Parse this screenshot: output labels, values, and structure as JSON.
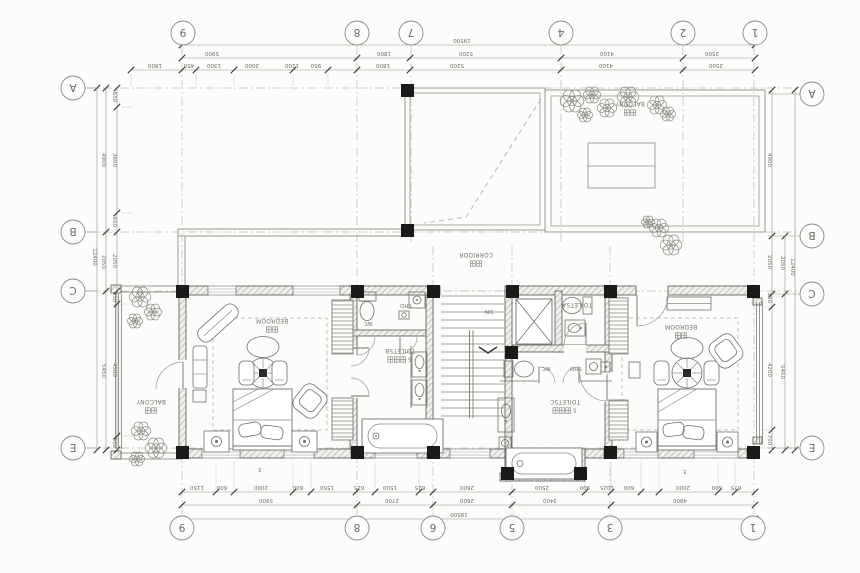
{
  "drawing": {
    "type": "architectural-floor-plan",
    "orientation": "rotated-180",
    "overall_width_mm": "19500",
    "overall_height_mm": "12400"
  },
  "colors": {
    "paper": "#fcfcfa",
    "line": "#8f8f8c",
    "dark": "#2f2f2d",
    "dim_text": "#6a6a66",
    "column": "#1a1a18",
    "hatch": "#a09f9c"
  },
  "bubbles": {
    "top": {
      "y": 33,
      "items": [
        {
          "t": "9",
          "x": 183
        },
        {
          "t": "8",
          "x": 357
        },
        {
          "t": "7",
          "x": 411
        },
        {
          "t": "4",
          "x": 561
        },
        {
          "t": "2",
          "x": 683
        },
        {
          "t": "1",
          "x": 755
        }
      ]
    },
    "bottom": {
      "y": 528,
      "items": [
        {
          "t": "9",
          "x": 182
        },
        {
          "t": "8",
          "x": 357
        },
        {
          "t": "6",
          "x": 433
        },
        {
          "t": "5",
          "x": 512
        },
        {
          "t": "3",
          "x": 610
        },
        {
          "t": "1",
          "x": 753
        }
      ]
    },
    "left": {
      "x": 73,
      "items": [
        {
          "t": "A",
          "y": 88
        },
        {
          "t": "B",
          "y": 232
        },
        {
          "t": "C",
          "y": 291
        },
        {
          "t": "E",
          "y": 448
        }
      ]
    },
    "right": {
      "x": 812,
      "items": [
        {
          "t": "A",
          "y": 94
        },
        {
          "t": "B",
          "y": 236
        },
        {
          "t": "C",
          "y": 294
        },
        {
          "t": "E",
          "y": 448
        }
      ]
    }
  },
  "dim_rows": [
    {
      "y": 45,
      "ticks": [
        182,
        755
      ],
      "labels": [
        {
          "t": "19500",
          "x": 462
        }
      ]
    },
    {
      "y": 58,
      "ticks": [
        182,
        357,
        410,
        561,
        683,
        755
      ],
      "labels": [
        {
          "t": "5900",
          "x": 212
        },
        {
          "t": "1800",
          "x": 384
        },
        {
          "t": "5200",
          "x": 466
        },
        {
          "t": "4100",
          "x": 607
        },
        {
          "t": "2500",
          "x": 712
        }
      ]
    },
    {
      "y": 70,
      "ticks": [
        131,
        182,
        196,
        234,
        293,
        328,
        357,
        410,
        561,
        683,
        755
      ],
      "labels": [
        {
          "t": "1800",
          "x": 155
        },
        {
          "t": "450",
          "x": 189
        },
        {
          "t": "1300",
          "x": 214
        },
        {
          "t": "2000",
          "x": 252
        },
        {
          "t": "1200",
          "x": 292
        },
        {
          "t": "950",
          "x": 316
        },
        {
          "t": "1800",
          "x": 383
        },
        {
          "t": "5200",
          "x": 457
        },
        {
          "t": "4100",
          "x": 606
        },
        {
          "t": "2500",
          "x": 716
        }
      ]
    },
    {
      "y": 492,
      "ticks": [
        182,
        216,
        234,
        293,
        311,
        356,
        375,
        419,
        433,
        512,
        585,
        611,
        641,
        659,
        718,
        735,
        755
      ],
      "labels": [
        {
          "t": "1150",
          "x": 197
        },
        {
          "t": "600",
          "x": 222
        },
        {
          "t": "2000",
          "x": 261
        },
        {
          "t": "600",
          "x": 298
        },
        {
          "t": "1550",
          "x": 327
        },
        {
          "t": "625",
          "x": 359
        },
        {
          "t": "1500",
          "x": 390
        },
        {
          "t": "625",
          "x": 420
        },
        {
          "t": "2600",
          "x": 467
        },
        {
          "t": "2500",
          "x": 542
        },
        {
          "t": "900",
          "x": 585
        },
        {
          "t": "1025",
          "x": 607
        },
        {
          "t": "600",
          "x": 629
        },
        {
          "t": "2000",
          "x": 683
        },
        {
          "t": "600",
          "x": 717
        },
        {
          "t": "675",
          "x": 736
        }
      ]
    },
    {
      "y": 505,
      "ticks": [
        182,
        357,
        433,
        512,
        611,
        755
      ],
      "labels": [
        {
          "t": "5900",
          "x": 266
        },
        {
          "t": "2700",
          "x": 392
        },
        {
          "t": "2600",
          "x": 467
        },
        {
          "t": "3400",
          "x": 550
        },
        {
          "t": "4900",
          "x": 680
        }
      ]
    },
    {
      "y": 519,
      "ticks": [
        182,
        755
      ],
      "labels": [
        {
          "t": "19500",
          "x": 459
        }
      ]
    }
  ],
  "dim_cols": [
    {
      "x": 117,
      "ticks": [
        88,
        107,
        213,
        232,
        291,
        304,
        436,
        450
      ],
      "labels": [
        {
          "t": "650",
          "y": 97
        },
        {
          "t": "3600",
          "y": 160
        },
        {
          "t": "650",
          "y": 222
        },
        {
          "t": "2050",
          "y": 261
        },
        {
          "t": "450",
          "y": 297
        },
        {
          "t": "4500",
          "y": 370
        },
        {
          "t": "500",
          "y": 443
        }
      ]
    },
    {
      "x": 106,
      "ticks": [
        88,
        232,
        291,
        450
      ],
      "labels": [
        {
          "t": "4900",
          "y": 160
        },
        {
          "t": "2050",
          "y": 262
        },
        {
          "t": "5450",
          "y": 371
        }
      ]
    },
    {
      "x": 97,
      "ticks": [
        88,
        450
      ],
      "labels": [
        {
          "t": "12400",
          "y": 257
        }
      ]
    },
    {
      "x": 772,
      "ticks": [
        90,
        236,
        294,
        307,
        430,
        450
      ],
      "labels": [
        {
          "t": "4900",
          "y": 160
        },
        {
          "t": "2050",
          "y": 262
        },
        {
          "t": "550",
          "y": 298
        },
        {
          "t": "4200",
          "y": 370
        },
        {
          "t": "700",
          "y": 440
        }
      ]
    },
    {
      "x": 785,
      "ticks": [
        236,
        294,
        450
      ],
      "labels": [
        {
          "t": "2050",
          "y": 263
        },
        {
          "t": "5450",
          "y": 372
        }
      ]
    },
    {
      "x": 795,
      "ticks": [
        90,
        450
      ],
      "labels": [
        {
          "t": "12400",
          "y": 267
        }
      ]
    }
  ],
  "room_labels": [
    {
      "id": "bedroom-left",
      "en": "BEDROOM",
      "zh": "主卧",
      "x": 272,
      "y": 321
    },
    {
      "id": "bedroom-right",
      "en": "BEDROOM",
      "zh": "主卧",
      "x": 681,
      "y": 327
    },
    {
      "id": "balcony-left",
      "en": "BALCONY",
      "zh": "阳台",
      "x": 151,
      "y": 402
    },
    {
      "id": "balcony-top",
      "en": "BALCONY",
      "zh": "阳台",
      "x": 630,
      "y": 104
    },
    {
      "id": "corridor",
      "en": "CORRIDOR",
      "zh": "走廊",
      "x": 476,
      "y": 255
    },
    {
      "id": "toilet-5b",
      "en": "TOILET5B",
      "zh": "卫生间5",
      "x": 400,
      "y": 351
    },
    {
      "id": "toilet-5c",
      "en": "TOILET5C",
      "zh": "卫生间5",
      "x": 565,
      "y": 402
    },
    {
      "id": "toilet-5a",
      "en": "TOILET5A",
      "zh": "",
      "x": 577,
      "y": 305
    }
  ],
  "small_labels": [
    {
      "t": "WC",
      "x": 368,
      "y": 324
    },
    {
      "t": "SHO",
      "x": 406,
      "y": 306
    },
    {
      "t": "WC",
      "x": 546,
      "y": 369
    },
    {
      "t": "SHO",
      "x": 576,
      "y": 369
    },
    {
      "t": "DN",
      "x": 489,
      "y": 312
    },
    {
      "t": "3",
      "x": 260,
      "y": 470
    },
    {
      "t": "3",
      "x": 685,
      "y": 472
    }
  ]
}
